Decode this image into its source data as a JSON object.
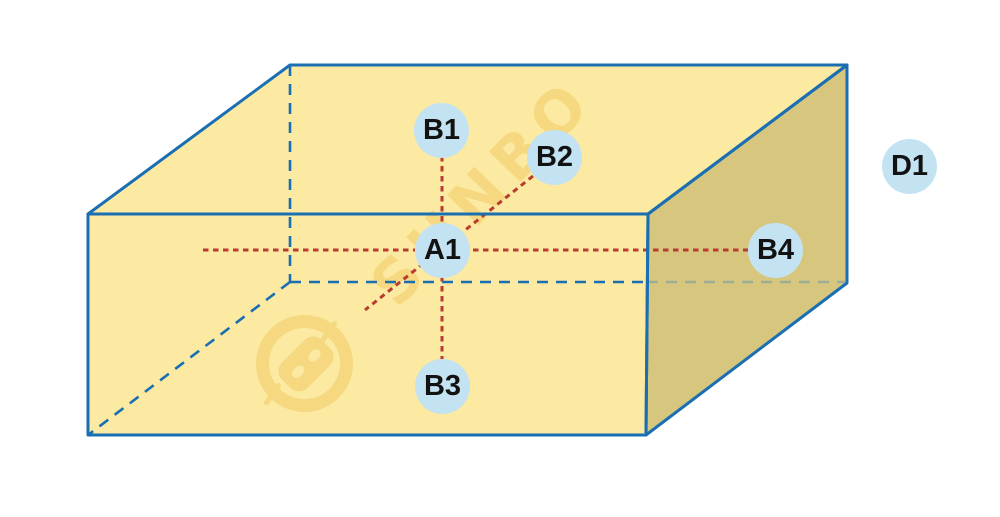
{
  "diagram": {
    "type": "3d-box-annotated-points",
    "points": [
      {
        "id": "B1",
        "label": "B1"
      },
      {
        "id": "B2",
        "label": "B2"
      },
      {
        "id": "A1",
        "label": "A1"
      },
      {
        "id": "B4",
        "label": "B4"
      },
      {
        "id": "B3",
        "label": "B3"
      },
      {
        "id": "D1",
        "label": "D1"
      }
    ],
    "watermark": {
      "text": "SUNBO",
      "logo": "robot-head-logo"
    },
    "colors": {
      "face_light": "#fce9a2",
      "face_dark": "#d7c67e",
      "edge_blue": "#1a6fb3",
      "hidden_edge_muted": "#9eae94",
      "red_line": "#b93b31",
      "node_fill": "#c3e3f3",
      "node_text": "#121212",
      "watermark_color": "#f5d87f"
    }
  }
}
